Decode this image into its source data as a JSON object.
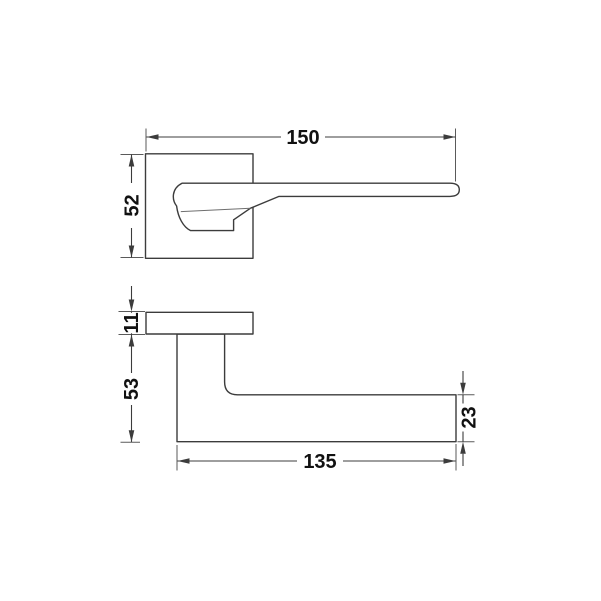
{
  "drawing": {
    "kind": "technical-dimension-drawing",
    "subject": "door-lever-handle-on-square-rosette",
    "colors": {
      "background": "#ffffff",
      "line": "#3c3c3c",
      "text": "#111111"
    },
    "views": {
      "front": {
        "dimensions": {
          "overall_length": "150",
          "rosette_height": "52"
        }
      },
      "side": {
        "dimensions": {
          "rosette_thickness": "11",
          "neck_projection": "53",
          "lever_thickness": "23",
          "lever_length": "135"
        }
      }
    }
  }
}
